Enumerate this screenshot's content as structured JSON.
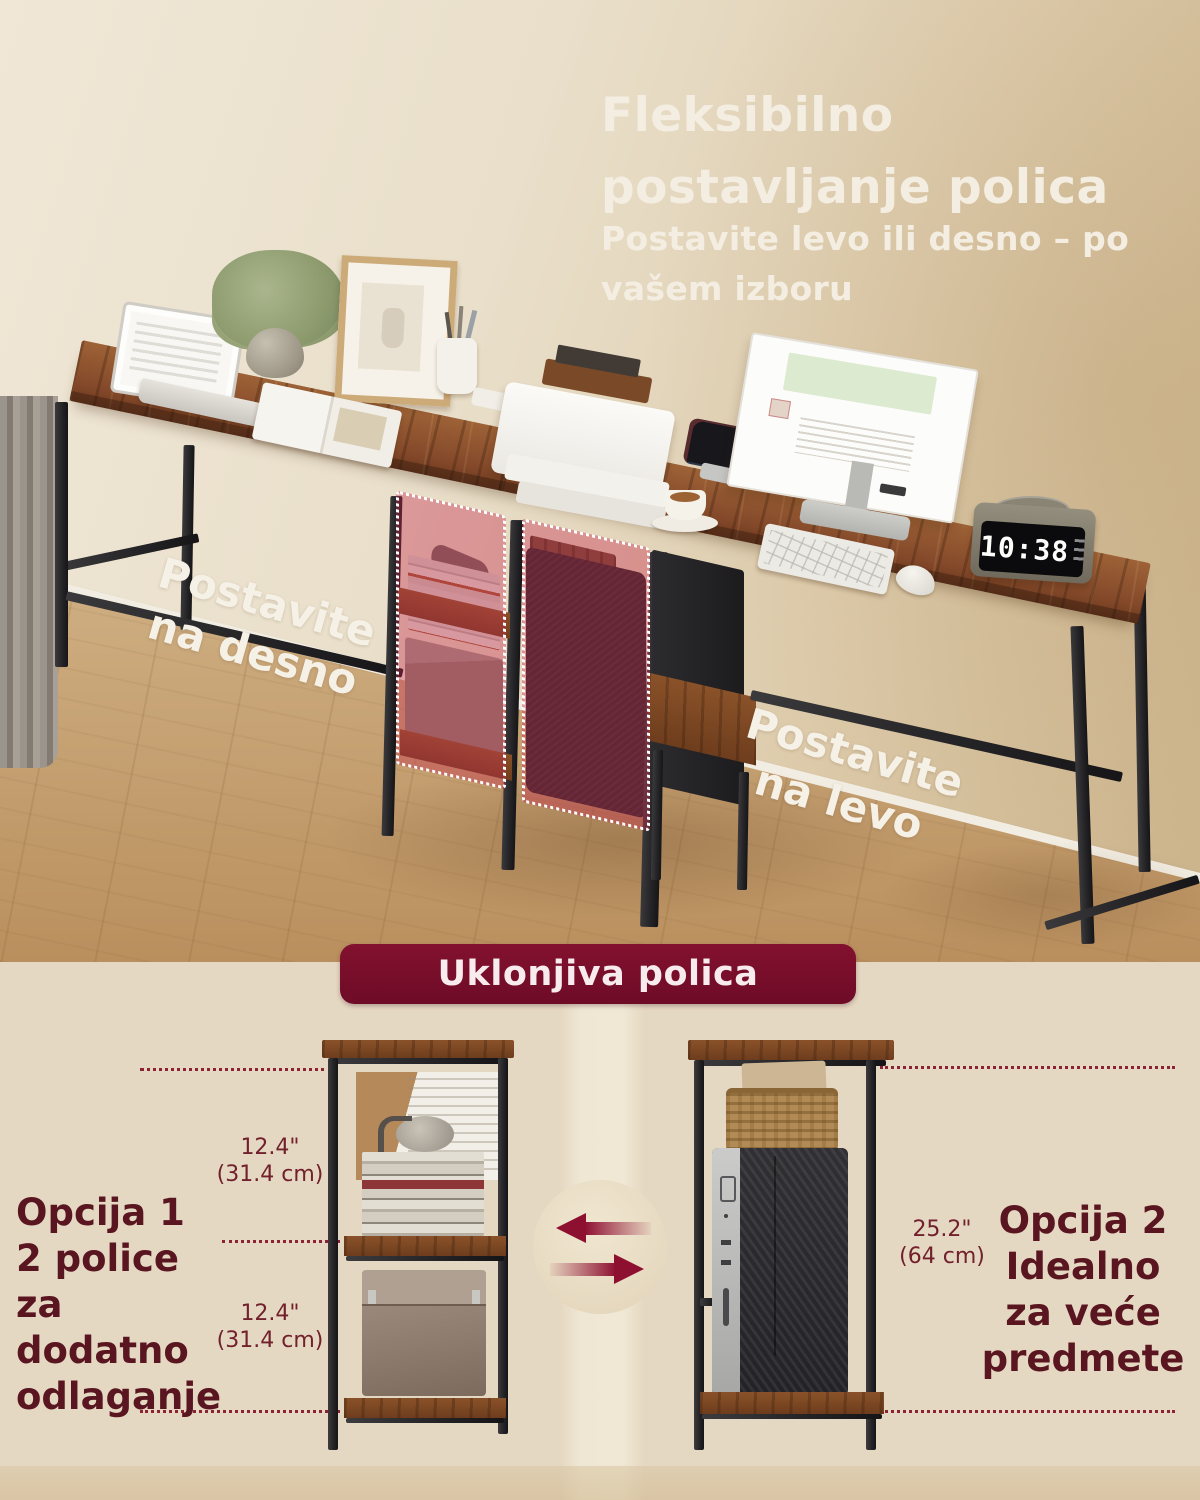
{
  "hero": {
    "title": [
      "Fleksibilno",
      "postavljanje polica"
    ],
    "subtitle": [
      "Postavite levo ili desno – po",
      "vašem izboru"
    ],
    "label_place_right": [
      "Postavite",
      "na desno"
    ],
    "label_place_left": [
      "Postavite",
      "na levo"
    ],
    "clock_time": "10:38"
  },
  "shelf_section": {
    "banner_label": "Uklonjiva polica",
    "option1": {
      "heading": "Opcija 1",
      "line1": "2 police za",
      "line2": "dodatno",
      "line3": "odlaganje"
    },
    "option2": {
      "heading": "Opcija 2",
      "line1": "Idealno",
      "line2": "za veće",
      "line3": "predmete"
    },
    "dim_upper": {
      "inches": "12.4\"",
      "cm": "(31.4 cm)"
    },
    "dim_lower": {
      "inches": "12.4\"",
      "cm": "(31.4 cm)"
    },
    "dim_right": {
      "inches": "25.2\"",
      "cm": "(64 cm)"
    }
  },
  "colors": {
    "banner_bg": "#7a0d2b",
    "maroon_text": "#5a1620",
    "dim_text": "#71202c",
    "dotted_line": "#8c2335",
    "highlight_tint": "rgba(198,44,78,0.40)",
    "hero_text": "#f4eee2",
    "desk_wood": "#84492a",
    "frame_black": "#252427",
    "page_beige": "#e5d8c2"
  }
}
